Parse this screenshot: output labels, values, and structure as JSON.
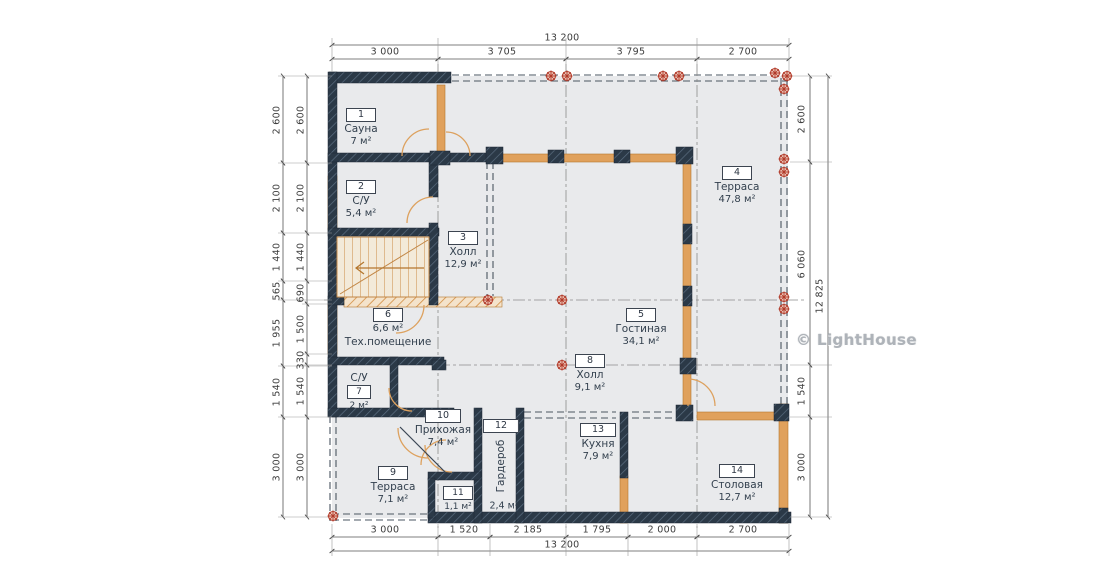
{
  "watermark": "© LightHouse",
  "dims": {
    "top": {
      "total": "13 200",
      "segments": [
        "3 000",
        "3 705",
        "3 795",
        "2 700"
      ]
    },
    "bottom": {
      "total": "13 200",
      "segments": [
        "3 000",
        "1 520",
        "2 185",
        "1 795",
        "2 000",
        "2 700"
      ]
    },
    "left_outer": [
      "2 600",
      "2 100",
      "1 440",
      "565",
      "1 955",
      "1 540",
      "3 000"
    ],
    "left_inner": [
      "2 600",
      "2 100",
      "1 440",
      "690",
      "1 500",
      "330",
      "1 540",
      "3 000"
    ],
    "right_inner": [
      "2 600",
      "6 060",
      "1 540",
      "3 000"
    ],
    "right_outer": "12 825"
  },
  "rooms": [
    {
      "number": "1",
      "name": "Сауна",
      "area": "7 м²"
    },
    {
      "number": "2",
      "name": "С/У",
      "area": "5,4 м²"
    },
    {
      "number": "3",
      "name": "Холл",
      "area": "12,9 м²"
    },
    {
      "number": "4",
      "name": "Терраса",
      "area": "47,8 м²"
    },
    {
      "number": "5",
      "name": "Гостиная",
      "area": "34,1 м²"
    },
    {
      "number": "6",
      "name": "Тех.помещение",
      "area": "6,6 м²"
    },
    {
      "number": "7",
      "name": "С/У",
      "area": "2 м²"
    },
    {
      "number": "8",
      "name": "Холл",
      "area": "9,1 м²"
    },
    {
      "number": "9",
      "name": "Терраса",
      "area": "7,1 м²"
    },
    {
      "number": "10",
      "name": "Прихожая",
      "area": "7,4 м²"
    },
    {
      "number": "11",
      "name": "",
      "area": "1,1 м²"
    },
    {
      "number": "12",
      "name": "Гардероб",
      "area": "2,4 м²"
    },
    {
      "number": "13",
      "name": "Кухня",
      "area": "7,9 м²"
    },
    {
      "number": "14",
      "name": "Столовая",
      "area": "12,7 м²"
    }
  ],
  "colors": {
    "wall": "#2b3947",
    "timber": "#e0a15c",
    "marker_red": "#b23b2a",
    "floor_fill": "#e9eaec"
  }
}
